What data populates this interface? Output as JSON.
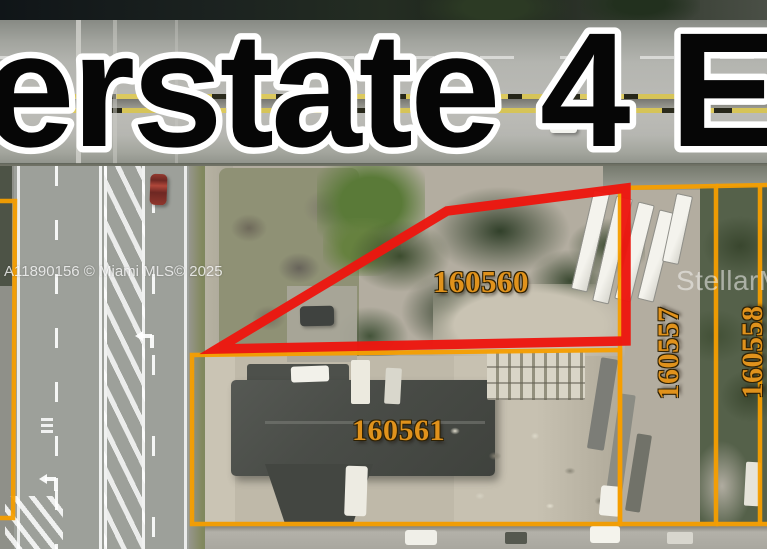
{
  "scene": {
    "type": "aerial-parcel-map-listing-photo",
    "road_name_overlay": "erstate 4 E"
  },
  "watermarks": {
    "listing_id": "A11890156 © Miami MLS© 2025",
    "brand": "StellarM"
  },
  "parcels": {
    "subject": {
      "label": "160560",
      "outline": "red"
    },
    "south": {
      "label": "160561",
      "outline": "orange"
    },
    "east_inner": {
      "label": "160557",
      "outline": "orange"
    },
    "east_outer": {
      "label": "160558",
      "outline": "orange"
    }
  },
  "colors": {
    "subject_outline": "#ec1710",
    "secondary_outline": "#f59e00",
    "parcel_label": "#e0921c",
    "title_fill": "#060606",
    "title_stroke": "#ffffff"
  }
}
